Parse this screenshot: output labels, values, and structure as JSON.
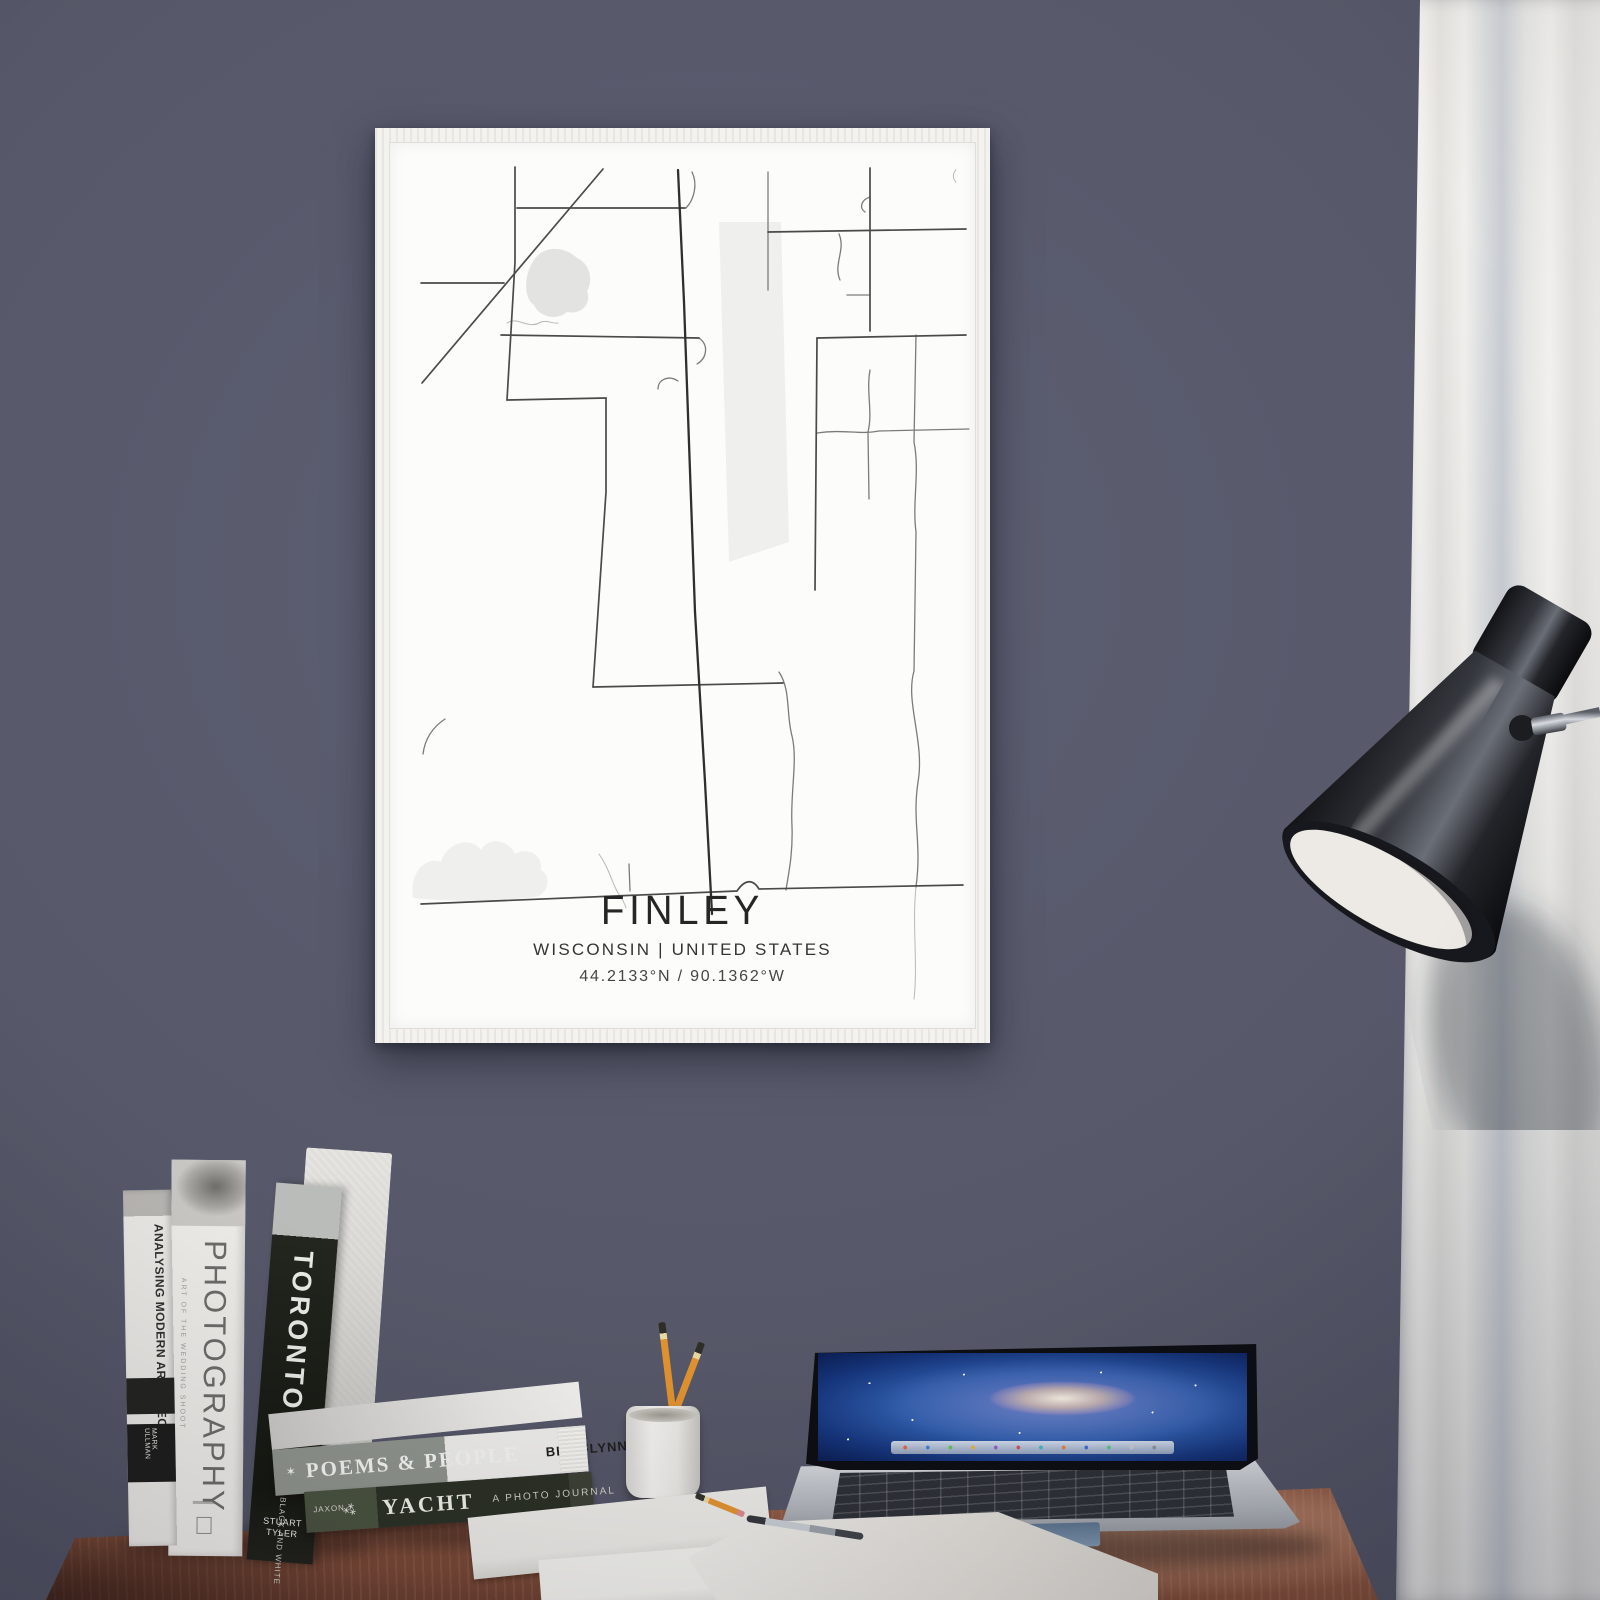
{
  "scene": {
    "wall_color": "#565869",
    "desk_color": "#8a5440",
    "curtain_color": "#eceae7",
    "frame_color": "#f3f2ee",
    "pencil_color": "#e2922f"
  },
  "poster": {
    "title": "FINLEY",
    "subtitle": "WISCONSIN | UNITED STATES",
    "coordinates": "44.2133°N / 90.1362°W",
    "map": {
      "road_color": "#3f3f3f",
      "water_color": "#e3e3e2",
      "roads": {
        "main": [
          "M289,28 L295,160 L306,470 L316,640 L323,772"
        ],
        "dark": [
          "M214,27 L33,241",
          "M126,25 L126,120 L118,258",
          "M128,66 L296,66",
          "M32,762 L348,749 C356,737 364,737 370,747 L574,743",
          "M481,26 L481,189",
          "M379,90 L577,87",
          "M428,196 L577,193",
          "M428,196 L426,448",
          "M204,545 L394,541",
          "M217,256 L217,350 L204,545",
          "M118,258 L217,256",
          "M112,193 L310,196",
          "M32,141 L115,141"
        ],
        "med": [
          "M303,30 C309,42 305,58 297,66",
          "M310,196 C320,203 318,216 308,222",
          "M269,247 C269,237 280,233 289,239",
          "M379,30 L379,148",
          "M450,92 C457,108 444,122 451,138",
          "M481,55 C472,58 470,66 476,70",
          "M458,153 L481,153",
          "M428,291 C455,287 470,293 490,289 L580,287",
          "M481,228 C477,250 484,270 479,290 L480,357",
          "M527,193 L525,300 C531,330 523,360 527,390 L525,529",
          "M525,529 C516,560 536,600 529,640 C523,680 533,700 527,745",
          "M390,530 C402,548 397,572 403,594 C409,618 401,652 403,684 C404,714 399,734 397,748",
          "M240,722 L241,749",
          "M56,577 C44,585 36,596 34,612"
        ],
        "light": [
          "M118,181 C128,174 139,187 150,181 C157,177 163,182 169,181",
          "M210,712 C220,726 223,741 229,751 C234,758 236,762 237,766",
          "M527,745 C523,782 529,822 525,857",
          "M567,28 C563,32 564,37 567,40"
        ]
      },
      "water": [
        "M149,113 C160,103 178,106 188,116 C200,121 205,137 198,149 C203,162 192,173 178,170 C168,179 150,175 145,163 C133,155 135,127 149,113 Z"
      ],
      "vegetation": [
        "M330,80 L392,80 L400,400 L340,420 Z",
        "M24,756 C20,734 34,714 52,720 C58,700 82,694 92,708 C100,694 120,698 126,712 C140,704 154,714 152,728 C162,734 160,748 150,754 C120,760 60,760 24,756 Z",
        "M60,726 C64,714 78,712 84,720 C94,714 104,722 100,732 C88,738 70,736 60,726 Z"
      ]
    }
  },
  "books": {
    "standing": [
      {
        "title": "ANALYSING MODERN ARCHITECTURE",
        "author": "MARK ULLMAN"
      },
      {
        "title": "PHOTOGRAPHY",
        "subtitle": "ART OF THE WEDDING SHOOT"
      },
      {
        "title": "TORONTO",
        "subtitle": "IN BLACK AND WHITE",
        "author": "STUART TYLER"
      }
    ],
    "stacked": [
      {
        "title": "POEMS & PEOPLE",
        "author": "BEN FLYNN",
        "icon": "star"
      },
      {
        "title": "YACHT",
        "subtitle": "A PHOTO JOURNAL",
        "author": "JAXON",
        "icon": "quill"
      }
    ]
  }
}
